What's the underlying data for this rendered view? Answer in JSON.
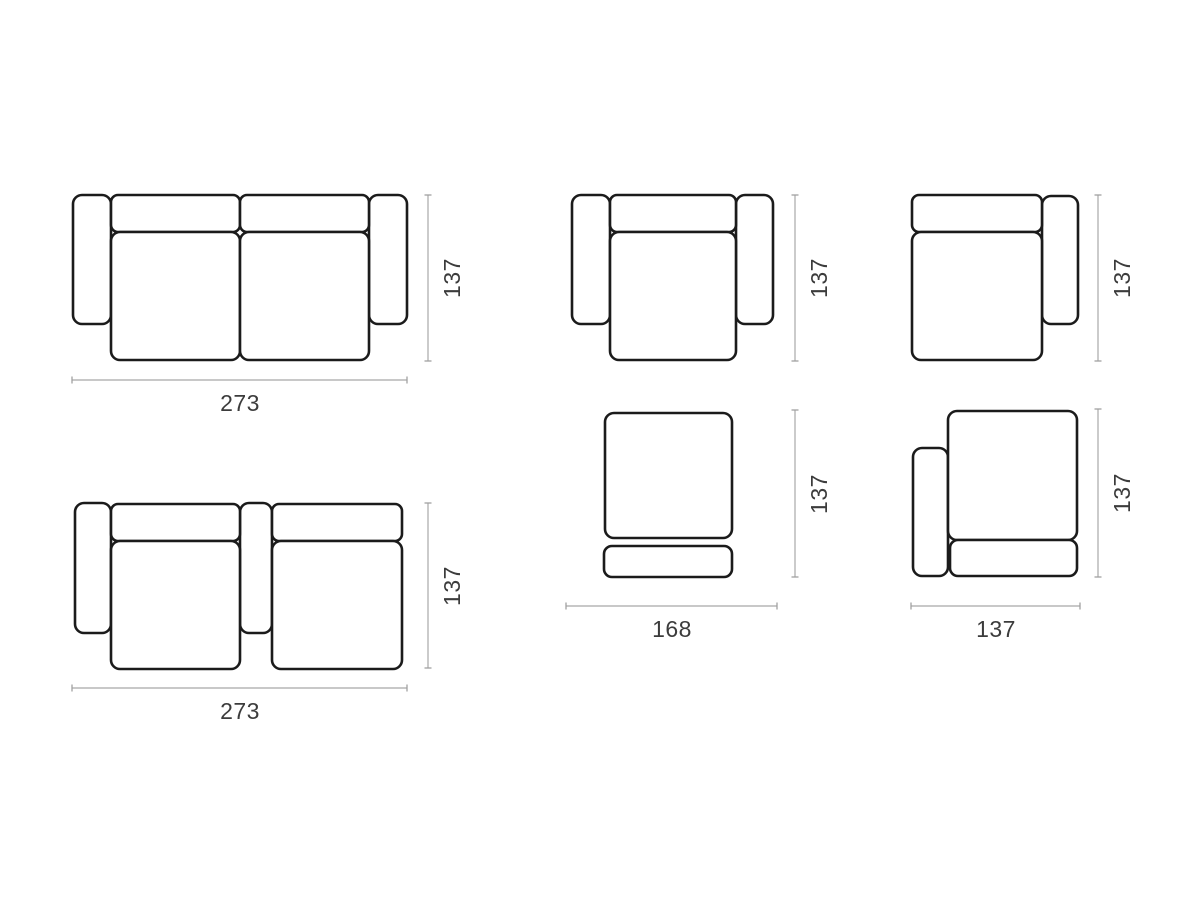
{
  "canvas": {
    "background": "#ffffff",
    "outline_color": "#1b1b1b",
    "dimension_line_color": "#b5b5b5",
    "label_color": "#3c3c3c"
  },
  "diagrams": [
    {
      "id": "two-seat-sofa-both-arms-top-view",
      "width_label": "273",
      "height_label": "137"
    },
    {
      "id": "armchair-both-arms-top-view",
      "height_label": "137"
    },
    {
      "id": "seat-module-right-arm-top-view",
      "height_label": "137"
    },
    {
      "id": "two-seat-modules-left-middle-arm-top-view",
      "width_label": "273",
      "height_label": "137"
    },
    {
      "id": "ottoman-module-top-view",
      "width_label": "168",
      "height_label": "137"
    },
    {
      "id": "seat-module-left-arm-top-view",
      "width_label": "137",
      "height_label": "137"
    }
  ]
}
